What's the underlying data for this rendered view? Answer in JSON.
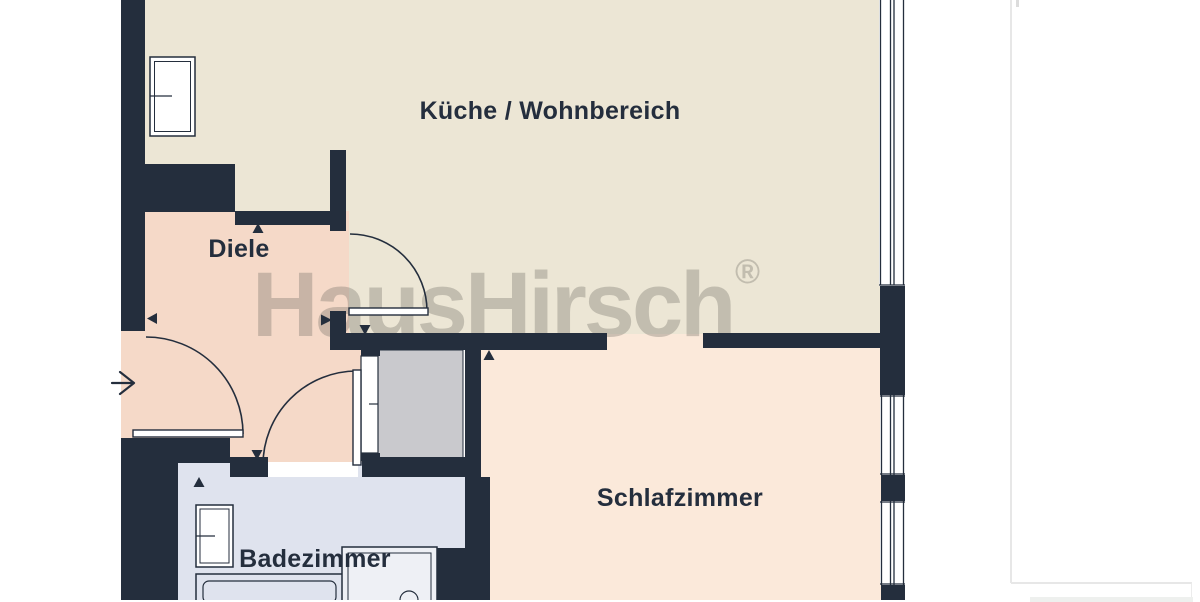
{
  "page": {
    "background": "#ffffff"
  },
  "right_panel": {
    "divider_color": "#e7e7e7"
  },
  "floorplan": {
    "watermark": {
      "text": "HausHirsch",
      "registered_mark": "®",
      "color": "#6d6b60"
    },
    "rooms": [
      {
        "name": "kueche-wohnbereich",
        "label": "Küche / Wohnbereich",
        "fill": "#ece6d5"
      },
      {
        "name": "diele",
        "label": "Diele",
        "fill": "#f5d9c8"
      },
      {
        "name": "schlafzimmer",
        "label": "Schlafzimmer",
        "fill": "#fbe9da"
      },
      {
        "name": "badezimmer",
        "label": "Badezimmer",
        "fill": "#dfe3ee"
      }
    ],
    "wall_color": "#242e3d",
    "label_color": "#242e3d",
    "shaft_fill": "#c9c9cd",
    "icons": [
      "entrance-arrow-icon",
      "door-swing-icon",
      "opening-marker-icon",
      "window-icon"
    ]
  }
}
